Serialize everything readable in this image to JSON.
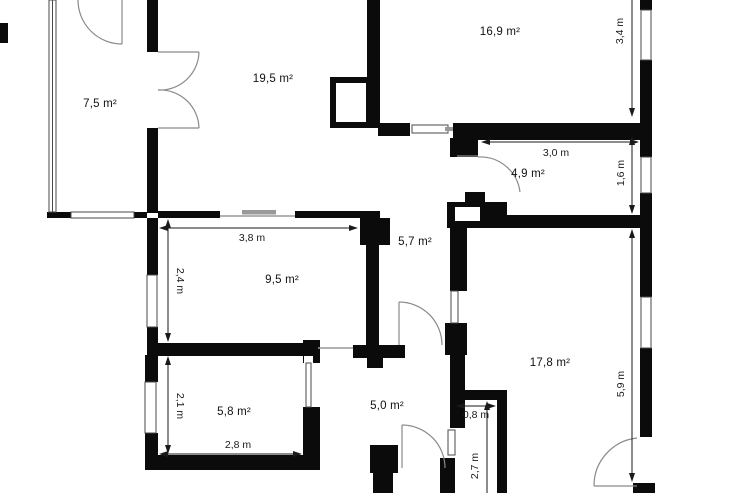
{
  "floorplan": {
    "type": "apartment-floor-plan",
    "rooms": [
      {
        "id": "winter-garden",
        "label": "7,5 m²"
      },
      {
        "id": "living-room",
        "label": "19,5 m²"
      },
      {
        "id": "room-top-right",
        "label": "16,9 m²"
      },
      {
        "id": "hallway",
        "label": "5,7 m²"
      },
      {
        "id": "room-small-right",
        "label": "4,9 m²"
      },
      {
        "id": "room-middle-left",
        "label": "9,5 m²"
      },
      {
        "id": "room-bottom-left",
        "label": "5,8 m²"
      },
      {
        "id": "inner-hall",
        "label": "5,0 m²"
      },
      {
        "id": "room-bottom-right",
        "label": "17,8 m²"
      }
    ],
    "dimensions": [
      {
        "id": "dim-3-8",
        "label": "3,8 m"
      },
      {
        "id": "dim-2-4",
        "label": "2,4 m"
      },
      {
        "id": "dim-2-1",
        "label": "2,1 m"
      },
      {
        "id": "dim-2-8",
        "label": "2,8 m"
      },
      {
        "id": "dim-3-4",
        "label": "3,4 m"
      },
      {
        "id": "dim-3-0",
        "label": "3,0 m"
      },
      {
        "id": "dim-1-6",
        "label": "1,6 m"
      },
      {
        "id": "dim-5-9",
        "label": "5,9 m"
      },
      {
        "id": "dim-0-8",
        "label": "0,8 m"
      },
      {
        "id": "dim-2-7",
        "label": "2,7 m"
      }
    ],
    "colors": {
      "wall": "#0b0b0b",
      "background": "#ffffff",
      "dimension": "#1a1a1a",
      "door": "#8a8a8a",
      "window_outline": "#4a4a4a",
      "opening": "#999999"
    }
  }
}
